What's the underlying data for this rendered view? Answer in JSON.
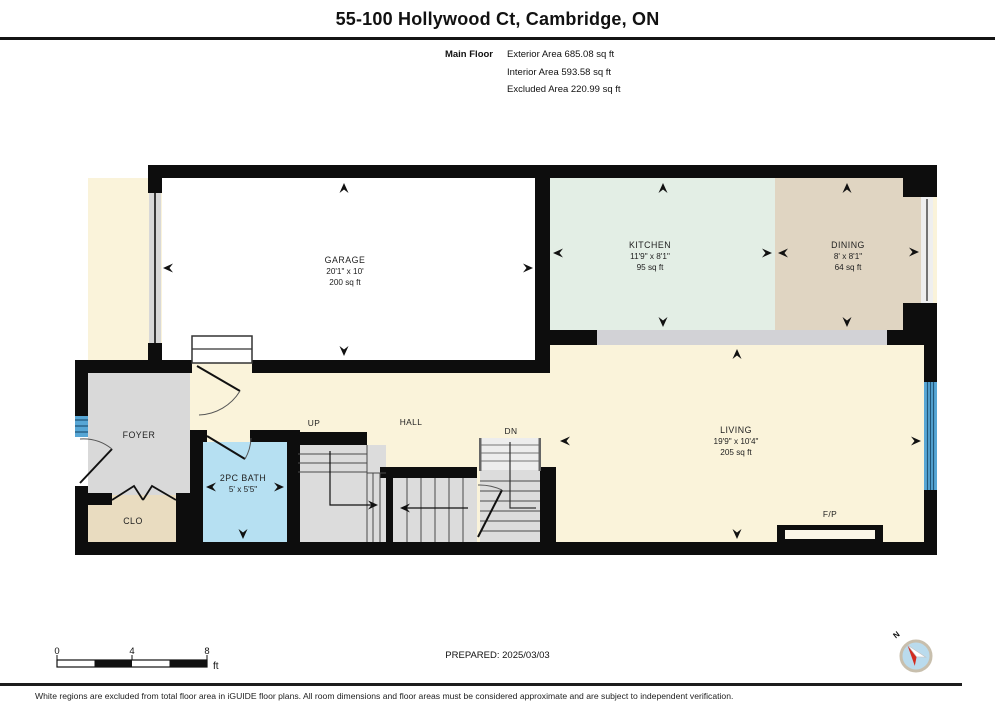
{
  "header": {
    "title": "55-100 Hollywood Ct, Cambridge, ON",
    "floor_label": "Main Floor",
    "area_lines": [
      "Exterior Area 685.08 sq ft",
      "Interior Area 593.58 sq ft",
      "Excluded Area 220.99 sq ft"
    ]
  },
  "rooms": {
    "garage": {
      "name": "GARAGE",
      "dims": "20'1\" x 10'",
      "area": "200 sq ft"
    },
    "kitchen": {
      "name": "KITCHEN",
      "dims": "11'9\" x 8'1\"",
      "area": "95 sq ft"
    },
    "dining": {
      "name": "DINING",
      "dims": "8' x 8'1\"",
      "area": "64 sq ft"
    },
    "living": {
      "name": "LIVING",
      "dims": "19'9\" x 10'4\"",
      "area": "205 sq ft"
    },
    "bath": {
      "name": "2PC BATH",
      "dims": "5' x 5'5\""
    },
    "foyer": {
      "name": "FOYER"
    },
    "closet": {
      "name": "CLO"
    },
    "hall": {
      "name": "HALL"
    }
  },
  "plan_labels": {
    "up": "UP",
    "down": "DN",
    "fireplace": "F/P",
    "north": "N"
  },
  "scale_bar": {
    "tick0": "0",
    "tick4": "4",
    "tick8": "8",
    "unit": "ft"
  },
  "footer": {
    "prepared": "PREPARED: 2025/03/03",
    "disclaimer": "White regions are excluded from total floor area in iGUIDE floor plans. All room dimensions and floor areas must be considered approximate and are subject to independent verification."
  },
  "colors": {
    "garage": "#ffffff",
    "kitchen": "#e3eee5",
    "dining": "#e0d5c2",
    "living": "#faf3da",
    "foyer": "#d9d9d9",
    "closet": "#e9dcc0",
    "bath": "#b6e0f2",
    "stairs": "#dcdcdc",
    "half_wall": "#d2d2d6",
    "window": "#57a6d5",
    "wall": "#111111"
  }
}
